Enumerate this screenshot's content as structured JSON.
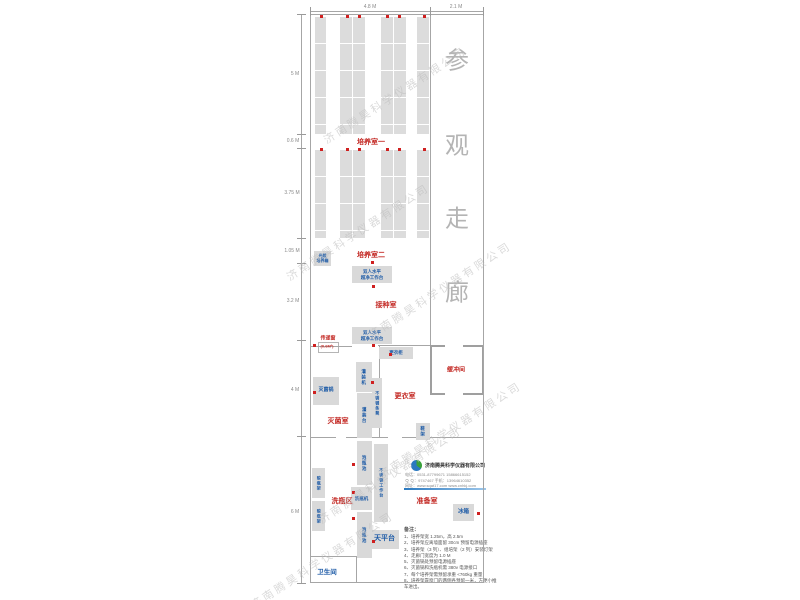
{
  "plan": {
    "corridor_label": "参观走廊",
    "watermark_text": "济南腾昊科学仪器有限公司",
    "top_dimensions": [
      {
        "label": "4.8 M",
        "x": 370,
        "y": 7
      },
      {
        "label": "2.1 M",
        "x": 456,
        "y": 7
      }
    ],
    "left_dimensions": [
      {
        "label": "5 M",
        "x": 295,
        "y": 74
      },
      {
        "label": "0.6 M",
        "x": 293,
        "y": 141
      },
      {
        "label": "3.75 M",
        "x": 292,
        "y": 193
      },
      {
        "label": "1.05 M",
        "x": 292,
        "y": 251
      },
      {
        "label": "3.2 M",
        "x": 293,
        "y": 301
      },
      {
        "label": "4 M",
        "x": 295,
        "y": 390
      },
      {
        "label": "6 M",
        "x": 295,
        "y": 512
      }
    ],
    "room_labels": [
      {
        "label": "培养室一",
        "x": 371,
        "y": 142,
        "color": "red",
        "fs": 7
      },
      {
        "label": "培养室二",
        "x": 371,
        "y": 255,
        "color": "red",
        "fs": 7
      },
      {
        "label": "接种室",
        "x": 386,
        "y": 305,
        "color": "red",
        "fs": 7
      },
      {
        "label": "灭菌室",
        "x": 338,
        "y": 421,
        "color": "red",
        "fs": 7
      },
      {
        "label": "更衣室",
        "x": 405,
        "y": 396,
        "color": "red",
        "fs": 7
      },
      {
        "label": "洗瓶区",
        "x": 342,
        "y": 501,
        "color": "red",
        "fs": 7
      },
      {
        "label": "准备室",
        "x": 427,
        "y": 501,
        "color": "red",
        "fs": 7
      },
      {
        "label": "传递窗",
        "x": 328,
        "y": 338,
        "color": "red",
        "fs": 5
      },
      {
        "label": "(0.6M²)",
        "x": 327,
        "y": 346,
        "color": "red",
        "fs": 4
      },
      {
        "label": "卫生间",
        "x": 327,
        "y": 571,
        "color": "blue",
        "fs": 6.5
      }
    ],
    "buffer_room": {
      "label": "缓冲间"
    },
    "equipment_boxes": [
      {
        "label": "光照\n培养箱",
        "x": 314,
        "y": 251,
        "w": 17,
        "h": 15,
        "fs": 4,
        "vert": false
      },
      {
        "label": "双人水平\n超净工作台",
        "x": 352,
        "y": 266,
        "w": 40,
        "h": 17,
        "fs": 4.5,
        "vert": false
      },
      {
        "label": "双人水平\n超净工作台",
        "x": 352,
        "y": 327,
        "w": 40,
        "h": 17,
        "fs": 4.5,
        "vert": false
      },
      {
        "label": "更衣柜",
        "x": 379,
        "y": 347,
        "w": 34,
        "h": 12,
        "fs": 4.5,
        "vert": false
      },
      {
        "label": "灌装机",
        "x": 356,
        "y": 362,
        "w": 16,
        "h": 30,
        "fs": 4.5,
        "vert": true
      },
      {
        "label": "不锈钢条凳",
        "x": 372,
        "y": 378,
        "w": 10,
        "h": 50,
        "fs": 4,
        "vert": true
      },
      {
        "label": "灌装台",
        "x": 357,
        "y": 393,
        "w": 15,
        "h": 45,
        "fs": 4.5,
        "vert": true
      },
      {
        "label": "灭菌锅",
        "x": 313,
        "y": 377,
        "w": 26,
        "h": 28,
        "fs": 5,
        "vert": false
      },
      {
        "label": "鞋架",
        "x": 416,
        "y": 423,
        "w": 14,
        "h": 17,
        "fs": 4.5,
        "vert": true
      },
      {
        "label": "泡瓶池",
        "x": 357,
        "y": 441,
        "w": 15,
        "h": 44,
        "fs": 4.5,
        "vert": true
      },
      {
        "label": "洗瓶机",
        "x": 351,
        "y": 487,
        "w": 21,
        "h": 23,
        "fs": 4.5,
        "vert": false
      },
      {
        "label": "泡瓶池",
        "x": 357,
        "y": 512,
        "w": 15,
        "h": 46,
        "fs": 4.5,
        "vert": true
      },
      {
        "label": "不锈钢工作台",
        "x": 374,
        "y": 444,
        "w": 14,
        "h": 78,
        "fs": 4,
        "vert": true
      },
      {
        "label": "晾瓶架",
        "x": 312,
        "y": 468,
        "w": 13,
        "h": 30,
        "fs": 4,
        "vert": true
      },
      {
        "label": "晾瓶架",
        "x": 312,
        "y": 501,
        "w": 13,
        "h": 30,
        "fs": 4,
        "vert": true
      },
      {
        "label": "天平台",
        "x": 370,
        "y": 530,
        "w": 29,
        "h": 19,
        "fs": 7,
        "vert": false
      },
      {
        "label": "冰箱",
        "x": 453,
        "y": 504,
        "w": 21,
        "h": 17,
        "fs": 5.5,
        "vert": false
      }
    ],
    "racks": [
      {
        "x": 315,
        "y": 17,
        "w": 11,
        "h": 117
      },
      {
        "x": 340,
        "y": 17,
        "w": 12,
        "h": 117
      },
      {
        "x": 353,
        "y": 17,
        "w": 12,
        "h": 117
      },
      {
        "x": 381,
        "y": 17,
        "w": 12,
        "h": 117
      },
      {
        "x": 394,
        "y": 17,
        "w": 12,
        "h": 117
      },
      {
        "x": 417,
        "y": 17,
        "w": 12,
        "h": 117
      },
      {
        "x": 315,
        "y": 150,
        "w": 11,
        "h": 88
      },
      {
        "x": 340,
        "y": 150,
        "w": 12,
        "h": 88
      },
      {
        "x": 353,
        "y": 150,
        "w": 12,
        "h": 88
      },
      {
        "x": 381,
        "y": 150,
        "w": 12,
        "h": 88
      },
      {
        "x": 394,
        "y": 150,
        "w": 12,
        "h": 88
      },
      {
        "x": 417,
        "y": 150,
        "w": 12,
        "h": 88
      }
    ],
    "dots": [
      [
        320,
        15
      ],
      [
        346,
        15
      ],
      [
        358,
        15
      ],
      [
        386,
        15
      ],
      [
        398,
        15
      ],
      [
        423,
        15
      ],
      [
        320,
        148
      ],
      [
        346,
        148
      ],
      [
        358,
        148
      ],
      [
        386,
        148
      ],
      [
        398,
        148
      ],
      [
        423,
        148
      ],
      [
        371,
        261
      ],
      [
        372,
        285
      ],
      [
        372,
        344
      ],
      [
        313,
        344
      ],
      [
        313,
        391
      ],
      [
        371,
        381
      ],
      [
        389,
        353
      ],
      [
        352,
        463
      ],
      [
        352,
        491
      ],
      [
        352,
        517
      ],
      [
        372,
        540
      ],
      [
        477,
        512
      ]
    ],
    "walls": [
      {
        "x": 310,
        "y": 14,
        "w": 174,
        "h": 1
      },
      {
        "x": 310,
        "y": 582,
        "w": 174,
        "h": 1
      },
      {
        "x": 310,
        "y": 14,
        "w": 1,
        "h": 569
      },
      {
        "x": 483,
        "y": 14,
        "w": 1,
        "h": 569
      },
      {
        "x": 430,
        "y": 14,
        "w": 1,
        "h": 331
      },
      {
        "x": 310,
        "y": 346,
        "w": 42,
        "h": 1
      },
      {
        "x": 378,
        "y": 345,
        "w": 52,
        "h": 1
      },
      {
        "x": 379,
        "y": 345,
        "w": 1,
        "h": 92
      },
      {
        "x": 310,
        "y": 437,
        "w": 173,
        "h": 1
      },
      {
        "x": 310,
        "y": 556,
        "w": 46,
        "h": 1
      },
      {
        "x": 356,
        "y": 556,
        "w": 1,
        "h": 27
      },
      {
        "x": 301,
        "y": 14,
        "w": 1,
        "h": 569
      },
      {
        "x": 310,
        "y": 11,
        "w": 173,
        "h": 1
      }
    ],
    "gaps": [
      {
        "x": 388,
        "y": 436,
        "w": 14,
        "h": 3
      },
      {
        "x": 336,
        "y": 436,
        "w": 10,
        "h": 3
      },
      {
        "x": 445,
        "y": 343,
        "w": 18,
        "h": 4
      },
      {
        "x": 445,
        "y": 391,
        "w": 18,
        "h": 4
      }
    ],
    "ticks": [
      {
        "x": 297,
        "y": 14,
        "w": 9,
        "h": 1
      },
      {
        "x": 297,
        "y": 134,
        "w": 9,
        "h": 1
      },
      {
        "x": 297,
        "y": 148,
        "w": 9,
        "h": 1
      },
      {
        "x": 297,
        "y": 238,
        "w": 9,
        "h": 1
      },
      {
        "x": 297,
        "y": 263,
        "w": 9,
        "h": 1
      },
      {
        "x": 297,
        "y": 340,
        "w": 9,
        "h": 1
      },
      {
        "x": 297,
        "y": 436,
        "w": 9,
        "h": 1
      },
      {
        "x": 297,
        "y": 583,
        "w": 9,
        "h": 1
      },
      {
        "x": 310,
        "y": 7,
        "w": 1,
        "h": 9
      },
      {
        "x": 430,
        "y": 7,
        "w": 1,
        "h": 9
      },
      {
        "x": 483,
        "y": 7,
        "w": 1,
        "h": 9
      }
    ],
    "corridor_chars": [
      {
        "ch": "参",
        "x": 457,
        "y": 58
      },
      {
        "ch": "观",
        "x": 457,
        "y": 143
      },
      {
        "ch": "走",
        "x": 457,
        "y": 216
      },
      {
        "ch": "廊",
        "x": 457,
        "y": 290
      }
    ],
    "watermarks": [
      {
        "x": 395,
        "y": 95
      },
      {
        "x": 358,
        "y": 232
      },
      {
        "x": 440,
        "y": 290
      },
      {
        "x": 450,
        "y": 430
      },
      {
        "x": 390,
        "y": 475
      },
      {
        "x": 322,
        "y": 560
      }
    ],
    "notes": {
      "title": "备注：",
      "items": [
        "1、培养架宽 1.25m，高 2.5m",
        "2、培养架应离墙面留 30cm 预留电源插座",
        "3、培养架（3 列）、组培架（2 列）安装灯架",
        "4、走廊门宽度为 1.0 M",
        "5、灭菌锅处预留电源插座",
        "6、灭菌锅和洗瓶机需 380v 电源接口",
        "7、每个培养架需预留承重 <760kg 重量",
        "8、培养架靠窗门的两侧各预留一米，方便小推车进出。"
      ]
    },
    "contact": {
      "company": "济南腾昊科学仪器有限公司",
      "lines": [
        "电话：0531-87799671  15866615152",
        "Ｑ Ｑ：9747467    手机：13964610352",
        "网址：www.sqat17.com   www.cnhkj.com"
      ]
    }
  }
}
